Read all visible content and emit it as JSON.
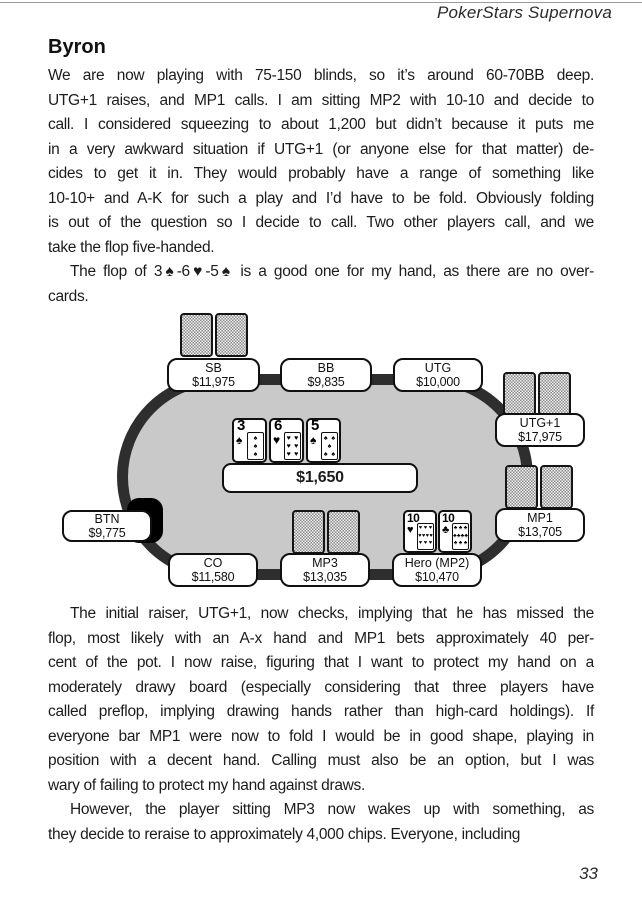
{
  "header": {
    "running_head": "PokerStars Supernova"
  },
  "footer": {
    "page_number": "33"
  },
  "heading": "Byron",
  "paragraphs": [
    {
      "indent": false,
      "lines": [
        "We are now playing with 75-150 blinds, so it’s around 60-70BB deep.",
        "UTG+1 raises, and MP1 calls. I am sitting MP2 with 10-10 and decide to",
        "call. I considered squeezing to about 1,200 but didn’t because it puts me",
        "in a very awkward situation if UTG+1 (or anyone else for that matter) de-",
        "cides to get it in. They would probably have a range of something like",
        "10-10+ and A-K for such a play and I’d have to be fold. Obviously folding",
        "is out of the question so I decide to call. Two other players call, and we",
        "take the flop five-handed."
      ]
    },
    {
      "indent": true,
      "lines": [
        "The flop of 3♠-6♥-5♠ is a good one for my hand, as there are no over-",
        "cards."
      ]
    },
    {
      "indent": true,
      "lines": [
        "The initial raiser, UTG+1, now checks, implying that he has missed the",
        "flop, most likely with an A-x hand and MP1 bets approximately 40 per-",
        "cent of the pot. I now raise, figuring that I want to protect my hand on a",
        "moderately drawy board (especially considering that three players have",
        "called preflop, implying drawing hands rather than high-card holdings). If",
        "everyone bar MP1 were now to fold I would be in good shape, playing in",
        "position with a decent hand. Calling must also be an option, but I was",
        "wary of failing to protect my hand against draws."
      ]
    },
    {
      "indent": true,
      "lines": [
        "However, the player sitting MP3 now wakes up with something, as",
        "they decide to reraise to approximately 4,000 chips. Everyone, including"
      ]
    }
  ],
  "table_diagram": {
    "pot_label": "$1,650",
    "board_cards": [
      {
        "rank": "3",
        "suit": "♠",
        "pip_rows": [
          1,
          1,
          1
        ]
      },
      {
        "rank": "6",
        "suit": "♥",
        "pip_rows": [
          2,
          2,
          2
        ]
      },
      {
        "rank": "5",
        "suit": "♠",
        "pip_rows": [
          2,
          1,
          2
        ]
      }
    ],
    "hero_cards": [
      {
        "rank": "10",
        "suit": "♥",
        "pip_rows": [
          3,
          4,
          3
        ]
      },
      {
        "rank": "10",
        "suit": "♣",
        "pip_rows": [
          3,
          4,
          3
        ]
      }
    ],
    "seats": [
      {
        "label": "SB",
        "stack": "$11,975"
      },
      {
        "label": "BB",
        "stack": "$9,835"
      },
      {
        "label": "UTG",
        "stack": "$10,000"
      },
      {
        "label": "UTG+1",
        "stack": "$17,975"
      },
      {
        "label": "MP1",
        "stack": "$13,705"
      },
      {
        "label": "Hero (MP2)",
        "stack": "$10,470"
      },
      {
        "label": "MP3",
        "stack": "$13,035"
      },
      {
        "label": "CO",
        "stack": "$11,580"
      },
      {
        "label": "BTN",
        "stack": "$9,775"
      }
    ]
  }
}
